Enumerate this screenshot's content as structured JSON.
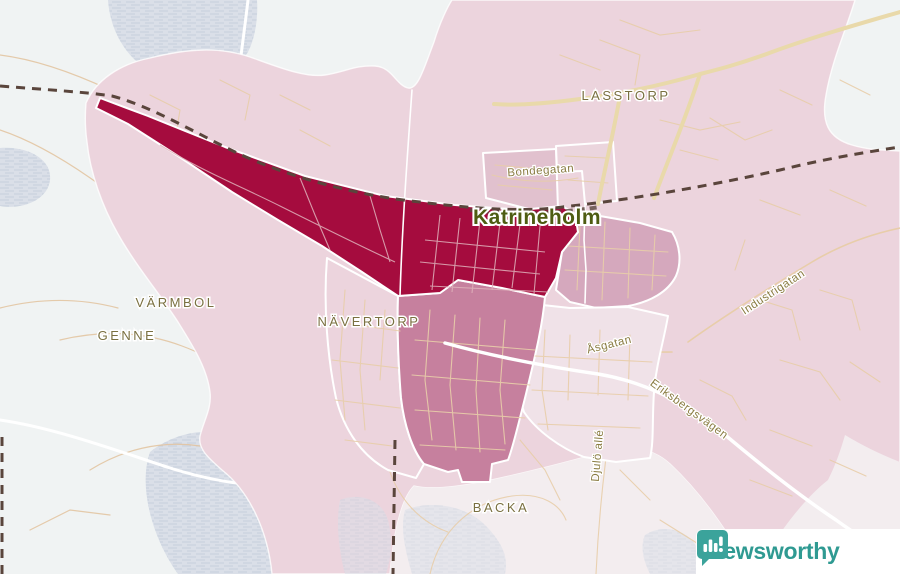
{
  "branding": {
    "name": "Newsworthy"
  },
  "colors": {
    "map_bg": "#f0f3f3",
    "water": "#dadfe8",
    "water_line": "#c6cfdc",
    "overlay_pink": "#ecd4dd",
    "gap_pale": "#f3edef",
    "rail": "#5a453c",
    "road_white": "#ffffff",
    "road_beige": "#e9d9aa",
    "road_tan": "#e2c29c",
    "road_tan_light": "#e8cda9",
    "grid_on_dark": "#dfb3bb",
    "border_white": "#ffffff",
    "label_place": "#7a7040",
    "label_city": "#4e5c12",
    "label_street": "#8a7c42",
    "brand_teal": "#3ba39b",
    "brand_text": "#2f9a92",
    "panel_bg": "#ffffff"
  },
  "choropleth": {
    "class_colors": [
      "#a50c3e",
      "#c6809e",
      "#d5a8bd",
      "#e1c1ce",
      "#ebd5dd",
      "#f0e2e8"
    ]
  },
  "map": {
    "city_label": "Katrineholm",
    "place_labels": {
      "lasstorp": "LASSTORP",
      "varmbol": "VÄRMBOL",
      "genne": "GENNE",
      "navertorp": "NÄVERTORP",
      "backa": "BACKA"
    },
    "street_labels": {
      "bondegatan": "Bondegatan",
      "industrigatan": "Industrigatan",
      "asgatan": "Åsgatan",
      "djulo": "Djulö allé",
      "eriksbergsvagen": "Eriksbergsvägen"
    }
  }
}
